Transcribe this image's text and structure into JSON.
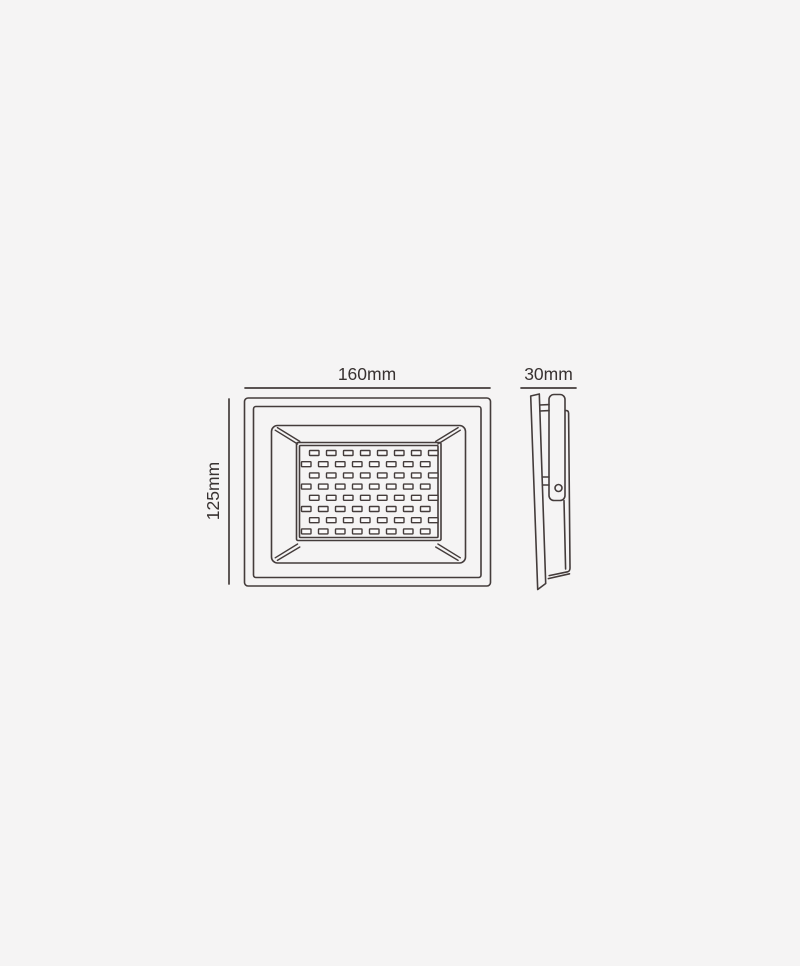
{
  "page": {
    "background_color": "#f5f4f4"
  },
  "drawing": {
    "line_color": "#443c3b",
    "text_color": "#383231",
    "led_fill_color": "#fbfafa",
    "dimensions": {
      "width_label": "160mm",
      "height_label": "125mm",
      "depth_label": "30mm"
    },
    "front_view": {
      "description": "floodlight-front-elevation",
      "led_grid": {
        "rows": 8,
        "cols": 8,
        "led_width": 9.5,
        "led_height": 5,
        "row_pitch": 11.2,
        "col_pitch": 17,
        "first_row_y": 450.5,
        "odd_row_x": 309.5,
        "even_row_x": 301.5
      }
    },
    "side_view": {
      "description": "floodlight-side-profile"
    }
  }
}
